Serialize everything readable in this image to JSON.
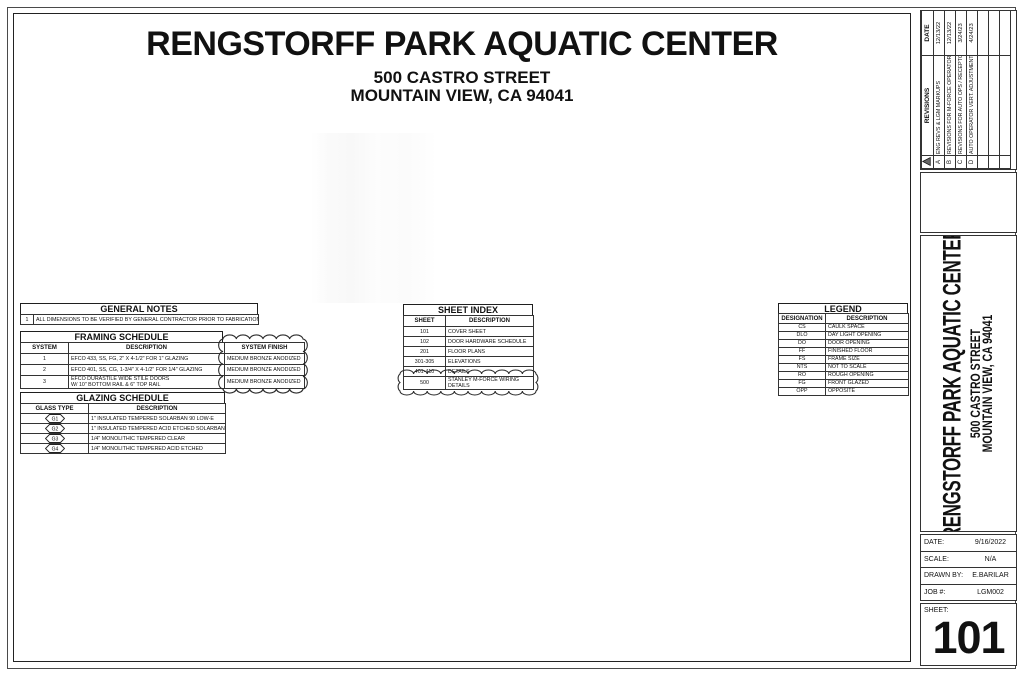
{
  "project": {
    "title": "RENGSTORFF PARK AQUATIC CENTER",
    "address1": "500 CASTRO STREET",
    "address2": "MOUNTAIN VIEW, CA 94041"
  },
  "general_notes": {
    "title": "GENERAL NOTES",
    "rows": [
      {
        "num": "1",
        "text": "ALL DIMENSIONS TO BE VERIFIED BY GENERAL CONTRACTOR PRIOR TO FABRICATION"
      }
    ]
  },
  "framing_schedule": {
    "title": "FRAMING SCHEDULE",
    "col_system": "SYSTEM",
    "col_description": "DESCRIPTION",
    "col_finish": "SYSTEM FINISH",
    "rows": [
      {
        "system": "1",
        "desc": "EFCO 433, SS, FG,  2\" X 4-1/2\" FOR 1\" GLAZING",
        "finish": "MEDIUM BRONZE ANODIZED"
      },
      {
        "system": "2",
        "desc": "EFCO 401, SS, CG, 1-3/4\" X 4-1/2\" FOR 1/4\" GLAZING",
        "finish": "MEDIUM BRONZE ANODIZED"
      },
      {
        "system": "3",
        "desc": "EFCO DURASTILE WIDE STILE DOORS",
        "desc2": "W/ 10\" BOTTOM RAIL & 6\" TOP RAIL",
        "finish": "MEDIUM BRONZE ANODIZED"
      }
    ]
  },
  "glazing_schedule": {
    "title": "GLAZING SCHEDULE",
    "col_type": "GLASS TYPE",
    "col_description": "DESCRIPTION",
    "rows": [
      {
        "type": "G1",
        "desc": "1\" INSULATED TEMPERED SOLARBAN 90 LOW-E"
      },
      {
        "type": "G2",
        "desc": "1\" INSULATED TEMPERED ACID ETCHED SOLARBAN 90 LOW-E"
      },
      {
        "type": "G3",
        "desc": "1/4\" MONOLITHIC TEMPERED CLEAR"
      },
      {
        "type": "G4",
        "desc": "1/4\" MONOLITHIC TEMPERED ACID ETCHED"
      }
    ]
  },
  "sheet_index": {
    "title": "SHEET INDEX",
    "col_sheet": "SHEET",
    "col_description": "DESCRIPTION",
    "rows": [
      {
        "sheet": "101",
        "desc": "COVER SHEET"
      },
      {
        "sheet": "102",
        "desc": "DOOR HARDWARE SCHEDULE"
      },
      {
        "sheet": "201",
        "desc": "FLOOR PLANS"
      },
      {
        "sheet": "301-305",
        "desc": "ELEVATIONS"
      },
      {
        "sheet": "401-410",
        "desc": "DETAILS"
      },
      {
        "sheet": "500",
        "desc": "STANLEY M-FORCE WIRING",
        "desc2": "DETAILS"
      }
    ]
  },
  "legend": {
    "title": "LEGEND",
    "col_designation": "DESIGNATION",
    "col_description": "DESCRIPTION",
    "rows": [
      {
        "designation": "CS",
        "desc": "CAULK SPACE"
      },
      {
        "designation": "DLO",
        "desc": "DAY LIGHT OPENING"
      },
      {
        "designation": "DO",
        "desc": "DOOR OPENING"
      },
      {
        "designation": "FF",
        "desc": "FINISHED FLOOR"
      },
      {
        "designation": "FS",
        "desc": "FRAME SIZE"
      },
      {
        "designation": "NTS",
        "desc": "NOT TO SCALE"
      },
      {
        "designation": "RO",
        "desc": "ROUGH OPENING"
      },
      {
        "designation": "FG",
        "desc": "FRONT GLAZED"
      },
      {
        "designation": "OPP",
        "desc": "OPPOSITE"
      }
    ]
  },
  "titleblock": {
    "revisions": {
      "col_revisions": "REVISIONS",
      "col_date": "DATE",
      "rows": [
        {
          "letter": "A",
          "desc": "ENG REVS & LGM MARKUPS",
          "date": "12/13/22"
        },
        {
          "letter": "B",
          "desc": "REVISIONS FOR M-FORCE OPERATOR",
          "date": "12/13/22"
        },
        {
          "letter": "C",
          "desc": "REVISIONS FOR AUTO OPS / RECEPTOR",
          "date": "3/24/23"
        },
        {
          "letter": "D",
          "desc": "AUTO OPERATOR VERT. ADJUSTMENT",
          "date": "4/24/23"
        },
        {
          "letter": "",
          "desc": "",
          "date": ""
        },
        {
          "letter": "",
          "desc": "",
          "date": ""
        },
        {
          "letter": "",
          "desc": "",
          "date": ""
        }
      ]
    },
    "project_title": "RENGSTORFF PARK AQUATIC CENTER",
    "project_address1": "500 CASTRO STREET",
    "project_address2": "MOUNTAIN VIEW, CA 94041",
    "info": {
      "rows": [
        {
          "label": "DATE:",
          "value": "9/16/2022"
        },
        {
          "label": "SCALE:",
          "value": "N/A"
        },
        {
          "label": "DRAWN BY:",
          "value": "E.BARILAR"
        },
        {
          "label": "JOB #:",
          "value": "LGM002"
        }
      ],
      "sheet_label": "SHEET:",
      "sheet_number": "101"
    }
  },
  "colors": {
    "line": "#333333",
    "text": "#111111",
    "paper": "#ffffff"
  }
}
